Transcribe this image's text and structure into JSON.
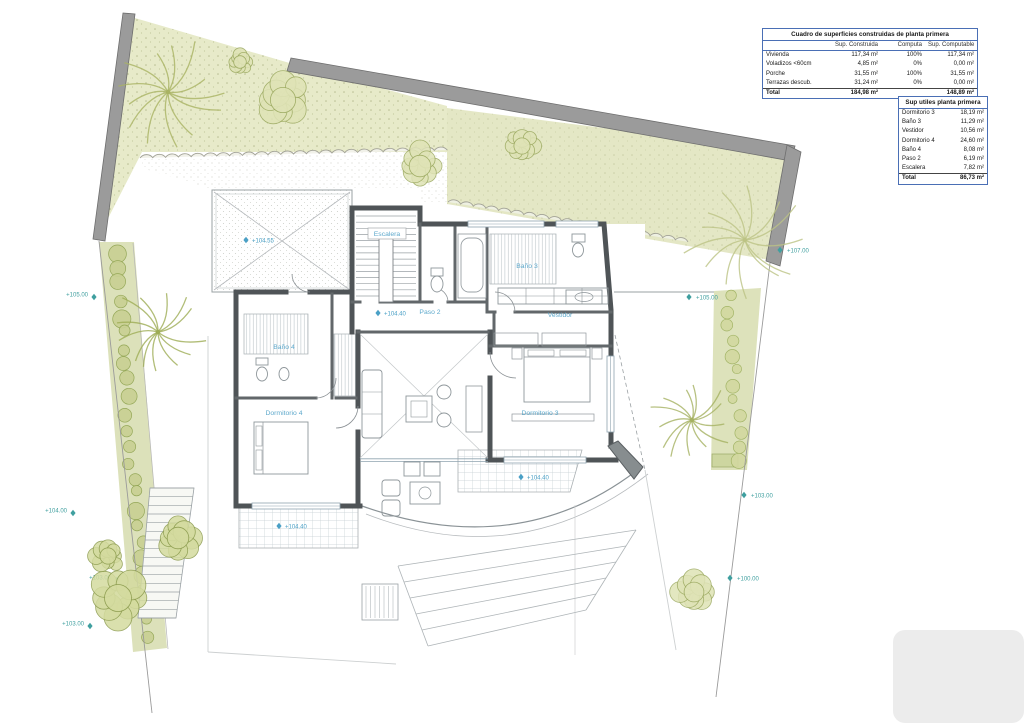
{
  "document": {
    "type": "architectural floor plan sheet",
    "floor": "planta primera"
  },
  "tables": {
    "constructed": {
      "title": "Cuadro de superficies construidas de planta primera",
      "columns": [
        "",
        "Sup. Construida",
        "Computa",
        "Sup. Computable"
      ],
      "rows": [
        {
          "label": "Vivienda",
          "built": "117,34 m²",
          "computes": "100%",
          "countable": "117,34 m²"
        },
        {
          "label": "Voladizos <60cm",
          "built": "4,85 m²",
          "computes": "0%",
          "countable": "0,00 m²"
        },
        {
          "label": "Porche",
          "built": "31,55 m²",
          "computes": "100%",
          "countable": "31,55 m²"
        },
        {
          "label": "Terrazas descub.",
          "built": "31,24 m²",
          "computes": "0%",
          "countable": "0,00 m²"
        }
      ],
      "total": {
        "label": "Total",
        "built": "184,98 m²",
        "computes": "",
        "countable": "148,89 m²"
      }
    },
    "useful": {
      "title": "Sup utiles planta primera",
      "rows": [
        {
          "label": "Dormitorio 3",
          "value": "18,19 m²"
        },
        {
          "label": "Baño 3",
          "value": "11,29 m²"
        },
        {
          "label": "Vestidor",
          "value": "10,56 m²"
        },
        {
          "label": "Dormitorio 4",
          "value": "24,60 m²"
        },
        {
          "label": "Baño 4",
          "value": "8,08 m²"
        },
        {
          "label": "Paso 2",
          "value": "6,19 m²"
        },
        {
          "label": "Escalera",
          "value": "7,82 m²"
        }
      ],
      "total": {
        "label": "Total",
        "value": "86,73 m²"
      }
    }
  },
  "plan": {
    "rooms": {
      "escalera": "Escalera",
      "bano3": "Baño 3",
      "paso2": "Paso 2",
      "vestidor": "Vestidor",
      "bano4": "Baño 4",
      "dormitorio4": "Dormitorio 4",
      "dormitorio3": "Dormitorio 3"
    },
    "floor_levels": [
      {
        "value": "+104.55"
      },
      {
        "value": "+104.40"
      },
      {
        "value": "+104.40"
      },
      {
        "value": "+104.40"
      }
    ],
    "site_levels": [
      {
        "value": "+107.00"
      },
      {
        "value": "+105.00"
      },
      {
        "value": "+104.00"
      },
      {
        "value": "+103.00"
      },
      {
        "value": "+103.00"
      },
      {
        "value": "+103.00"
      },
      {
        "value": "+100.00"
      },
      {
        "value": "+105.00"
      }
    ]
  },
  "colors": {
    "table_border": "#4a6fb5",
    "site_wall": "#9b9b9b",
    "house_wall": "#4f5457",
    "garden": "#e4e7c5",
    "foliage": "#a9b363",
    "site_marker": "#3f9f9f",
    "floor_marker": "#4aa0c6"
  }
}
